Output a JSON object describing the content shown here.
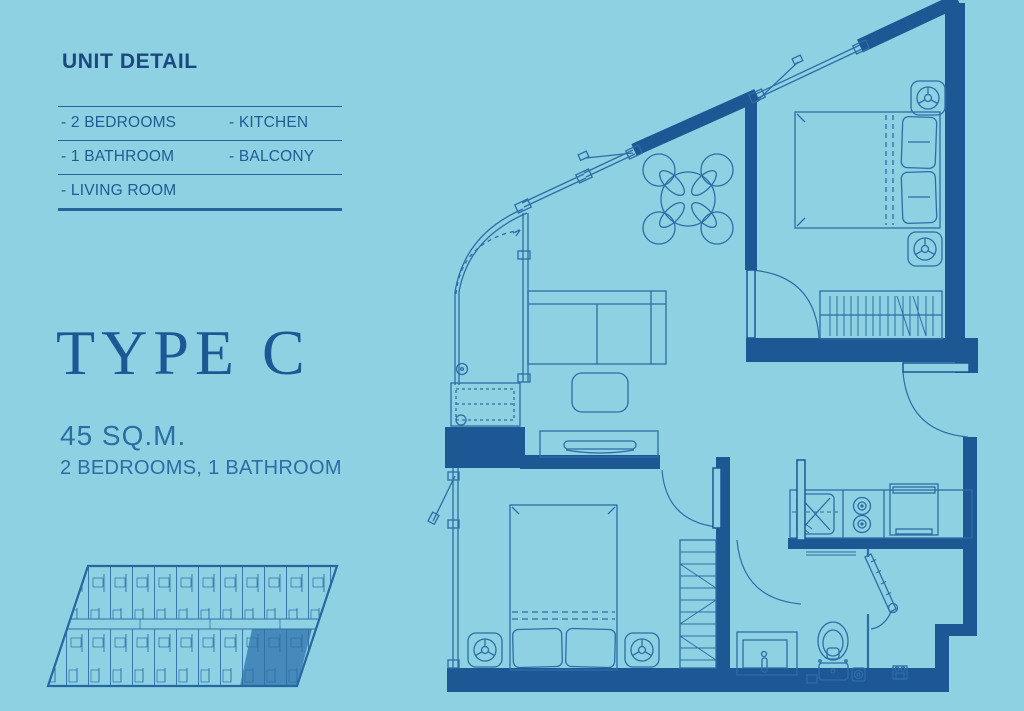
{
  "colors": {
    "background": "#8dd1e2",
    "wall": "#1d5794",
    "line": "#2e6da6",
    "heading_text": "#19497f",
    "body_text": "#2d6ca4",
    "highlight_unit": "#3a7cb4"
  },
  "unit_detail": {
    "title": "UNIT DETAIL",
    "rows": [
      [
        "- 2 BEDROOMS",
        "- KITCHEN"
      ],
      [
        "- 1 BATHROOM",
        "- BALCONY"
      ],
      [
        "- LIVING ROOM",
        ""
      ]
    ]
  },
  "unit_type": {
    "name": "TYPE C",
    "area": "45 SQ.M.",
    "configuration": "2 BEDROOMS, 1 BATHROOM"
  }
}
